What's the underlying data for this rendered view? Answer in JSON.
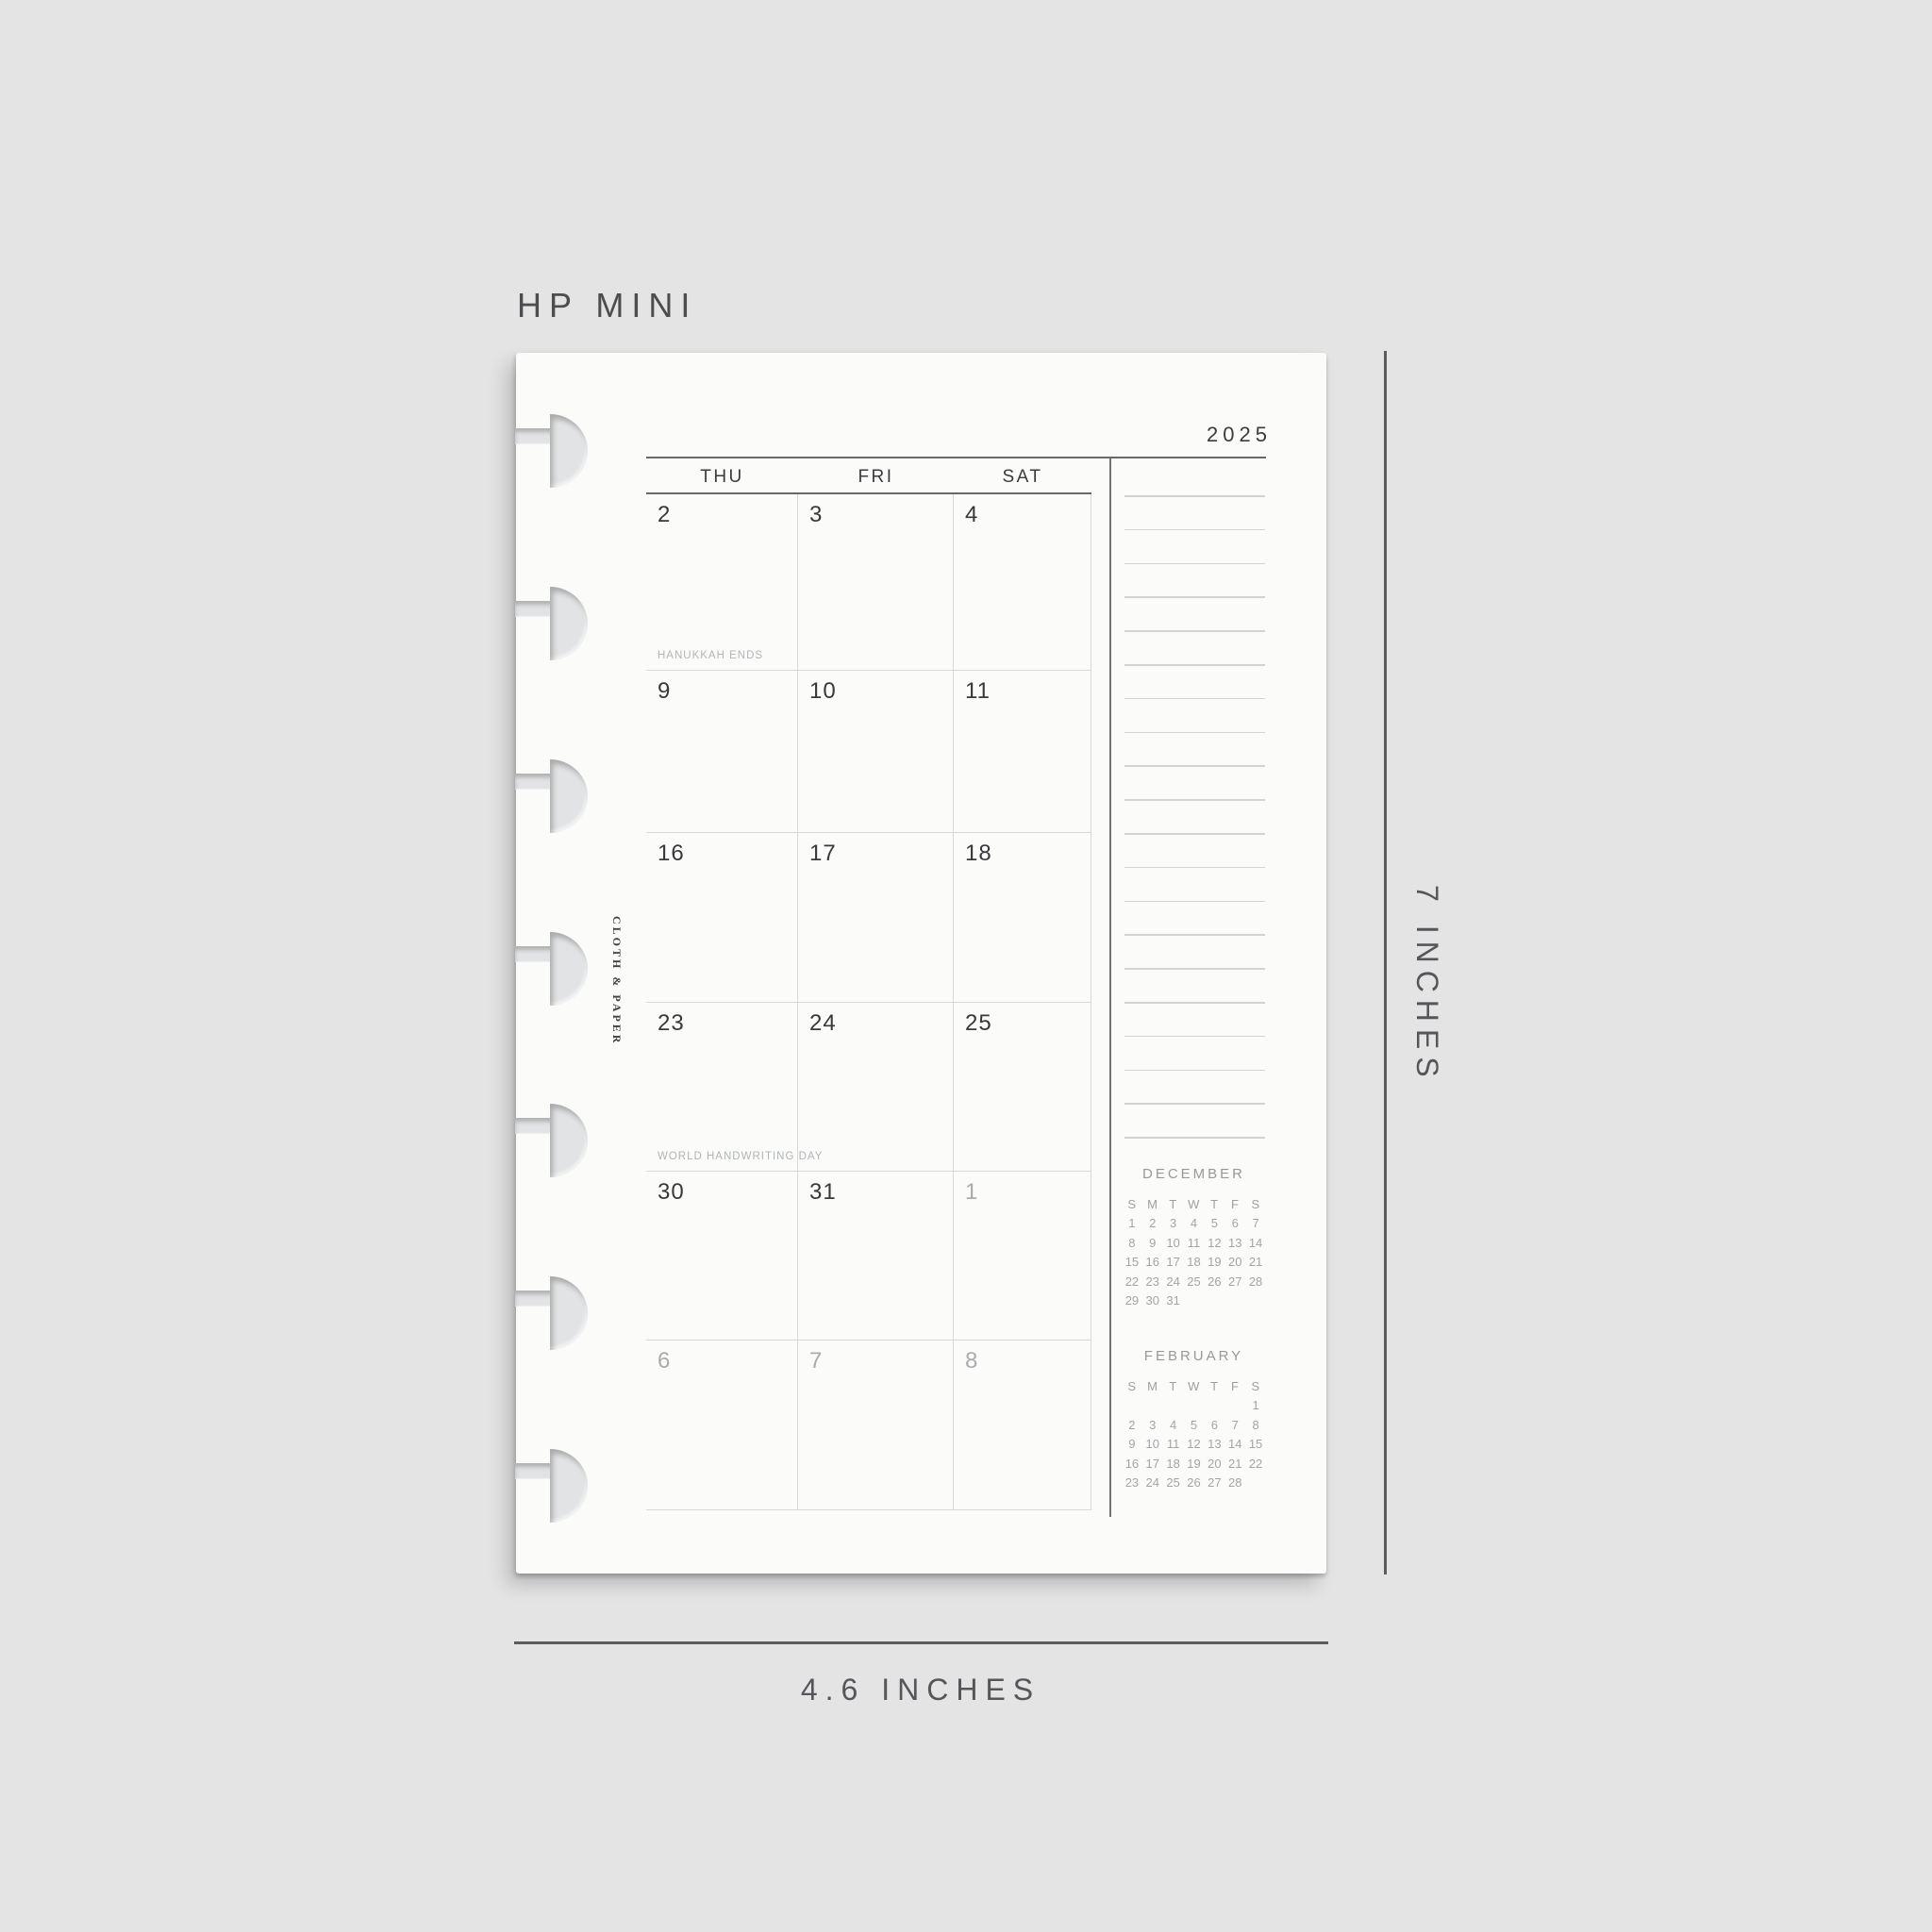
{
  "labels": {
    "size_name": "HP MINI",
    "width": "4.6 INCHES",
    "height": "7 INCHES"
  },
  "page": {
    "brand": "CLOTH & PAPER",
    "year": "2025",
    "calendar": {
      "day_headers": [
        "THU",
        "FRI",
        "SAT"
      ],
      "weeks": [
        [
          {
            "day": "2",
            "muted": false,
            "event": "HANUKKAH ENDS"
          },
          {
            "day": "3",
            "muted": false
          },
          {
            "day": "4",
            "muted": false
          }
        ],
        [
          {
            "day": "9",
            "muted": false
          },
          {
            "day": "10",
            "muted": false
          },
          {
            "day": "11",
            "muted": false
          }
        ],
        [
          {
            "day": "16",
            "muted": false
          },
          {
            "day": "17",
            "muted": false
          },
          {
            "day": "18",
            "muted": false
          }
        ],
        [
          {
            "day": "23",
            "muted": false,
            "event": "WORLD HANDWRITING DAY"
          },
          {
            "day": "24",
            "muted": false
          },
          {
            "day": "25",
            "muted": false
          }
        ],
        [
          {
            "day": "30",
            "muted": false
          },
          {
            "day": "31",
            "muted": false
          },
          {
            "day": "1",
            "muted": true
          }
        ],
        [
          {
            "day": "6",
            "muted": true
          },
          {
            "day": "7",
            "muted": true
          },
          {
            "day": "8",
            "muted": true
          }
        ]
      ]
    },
    "sidebar": {
      "ruled_line_count": 20,
      "mini_calendars": [
        {
          "title": "DECEMBER",
          "day_headers": [
            "S",
            "M",
            "T",
            "W",
            "T",
            "F",
            "S"
          ],
          "weeks": [
            [
              "1",
              "2",
              "3",
              "4",
              "5",
              "6",
              "7"
            ],
            [
              "8",
              "9",
              "10",
              "11",
              "12",
              "13",
              "14"
            ],
            [
              "15",
              "16",
              "17",
              "18",
              "19",
              "20",
              "21"
            ],
            [
              "22",
              "23",
              "24",
              "25",
              "26",
              "27",
              "28"
            ],
            [
              "29",
              "30",
              "31",
              "",
              "",
              "",
              ""
            ]
          ]
        },
        {
          "title": "FEBRUARY",
          "day_headers": [
            "S",
            "M",
            "T",
            "W",
            "T",
            "F",
            "S"
          ],
          "weeks": [
            [
              "",
              "",
              "",
              "",
              "",
              "",
              "1"
            ],
            [
              "2",
              "3",
              "4",
              "5",
              "6",
              "7",
              "8"
            ],
            [
              "9",
              "10",
              "11",
              "12",
              "13",
              "14",
              "15"
            ],
            [
              "16",
              "17",
              "18",
              "19",
              "20",
              "21",
              "22"
            ],
            [
              "23",
              "24",
              "25",
              "26",
              "27",
              "28",
              ""
            ]
          ]
        }
      ]
    }
  },
  "colors": {
    "background": "#e4e4e5",
    "paper": "#fbfbfa",
    "ink": "#37393b",
    "muted_ink": "#a9abad",
    "event_label": "#b2b5b7",
    "line_dark": "#66686a",
    "line_light": "#d4d6d7",
    "measure": "#54565a"
  }
}
